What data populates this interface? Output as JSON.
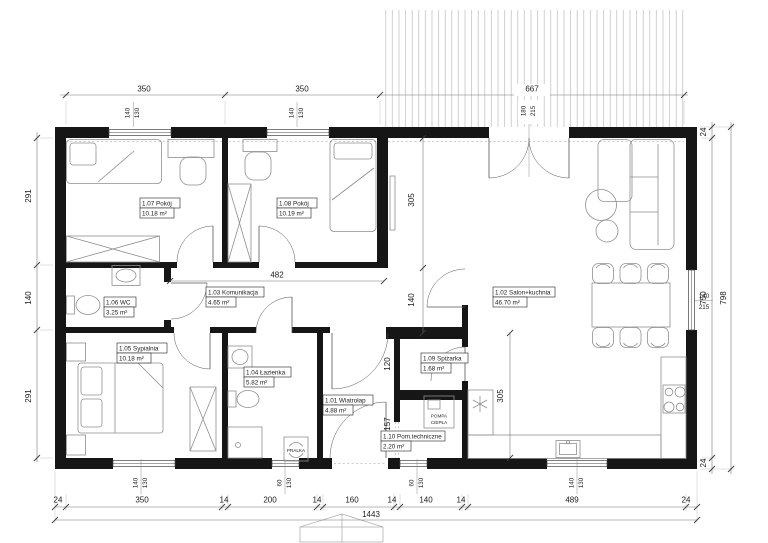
{
  "rooms": [
    {
      "title": "1.07 Pokój",
      "area": "10.18 m²"
    },
    {
      "title": "1.08 Pokój",
      "area": "10.19 m²"
    },
    {
      "title": "1.06 WC",
      "area": "3.25 m²"
    },
    {
      "title": "1.03 Komunikacja",
      "area": "4.65 m²"
    },
    {
      "title": "1.05 Sypialnia",
      "area": "10.18 m²"
    },
    {
      "title": "1.04 Łazienka",
      "area": "5.82 m²"
    },
    {
      "title": "1.01 Wiatrołap",
      "area": "4.88 m²"
    },
    {
      "title": "1.10 Pom.techniczne",
      "area": "2.20 m²"
    },
    {
      "title": "1.09 Spiżarka",
      "area": "1.68 m²"
    },
    {
      "title": "1.02 Salon+kuchnia",
      "area": "46.70 m²"
    }
  ],
  "dims": {
    "top": [
      "350",
      "350",
      "667"
    ],
    "left": [
      "291",
      "140",
      "291"
    ],
    "right": [
      "24",
      "750",
      "798",
      "24"
    ],
    "bottom": [
      "24",
      "350",
      "14",
      "200",
      "14",
      "160",
      "14",
      "140",
      "14",
      "489",
      "24"
    ],
    "total": "1443",
    "interior": {
      "hall": "482",
      "salon_height": "305",
      "corridor": "140",
      "pantry": "120",
      "tech": "157",
      "kitchen": "305"
    },
    "win_pairs": {
      "p107": [
        "140",
        "130"
      ],
      "p108": [
        "140",
        "130"
      ],
      "terrace_door": [
        "180",
        "215"
      ],
      "bedroom": [
        "140",
        "130"
      ],
      "bath": [
        "60",
        "130"
      ],
      "tech": [
        "60",
        "130"
      ],
      "kitchen": [
        "140",
        "130"
      ],
      "right": [
        "140",
        "215"
      ]
    }
  },
  "equipment": {
    "washer": "PRALKA",
    "heat_pump_line1": "POMPA",
    "heat_pump_line2": "CIEPŁA"
  }
}
